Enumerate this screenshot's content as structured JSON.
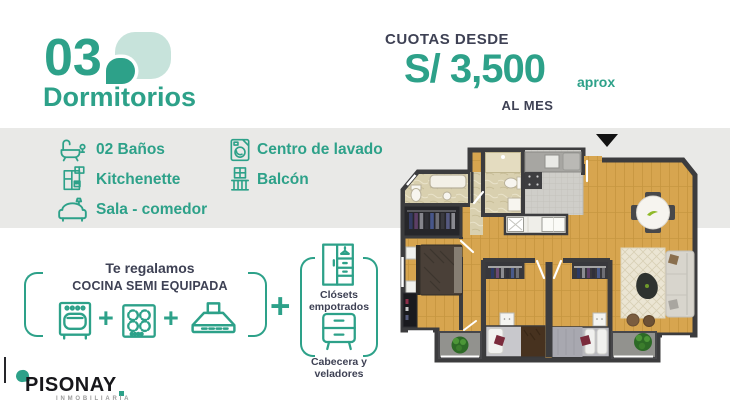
{
  "colors": {
    "accent": "#2da189",
    "accent_light": "#c7e3db",
    "dark_text": "#3e4154",
    "band_bg": "#e9e9e7",
    "wall": "#3c3c3e",
    "wood_floor": "#d7a54f",
    "logo_black": "#17171b",
    "logo_gray": "#9b9b9b"
  },
  "header": {
    "number": "03",
    "title": "Dormitorios",
    "icon": "leaf-icon"
  },
  "price": {
    "label": "CUOTAS DESDE",
    "amount": "S/ 3,500",
    "approx": "aprox",
    "period": "AL MES"
  },
  "features": {
    "col1": [
      {
        "icon": "bathtub-icon",
        "label": "02 Baños"
      },
      {
        "icon": "kitchenette-icon",
        "label": "Kitchenette"
      },
      {
        "icon": "sofa-icon",
        "label": "Sala - comedor"
      }
    ],
    "col2": [
      {
        "icon": "washing-machine-icon",
        "label": "Centro de lavado"
      },
      {
        "icon": "balcony-icon",
        "label": "Balcón"
      }
    ]
  },
  "promo": {
    "intro": "Te regalamos",
    "headline": "COCINA SEMI EQUIPADA",
    "kitchen_icons": [
      "oven-icon",
      "cooktop-icon",
      "range-hood-icon"
    ],
    "plus": "+",
    "extras": [
      {
        "icon": "closet-icon",
        "label": "Clósets empotrados"
      },
      {
        "icon": "nightstand-icon",
        "label": "Cabecera y veladores"
      }
    ]
  },
  "floorplan": {
    "entrance_marker": "black-triangle",
    "content": "3-bedroom apartment top view"
  },
  "logo": {
    "name": "PISONAY",
    "tagline": "INMOBILIARIA"
  }
}
